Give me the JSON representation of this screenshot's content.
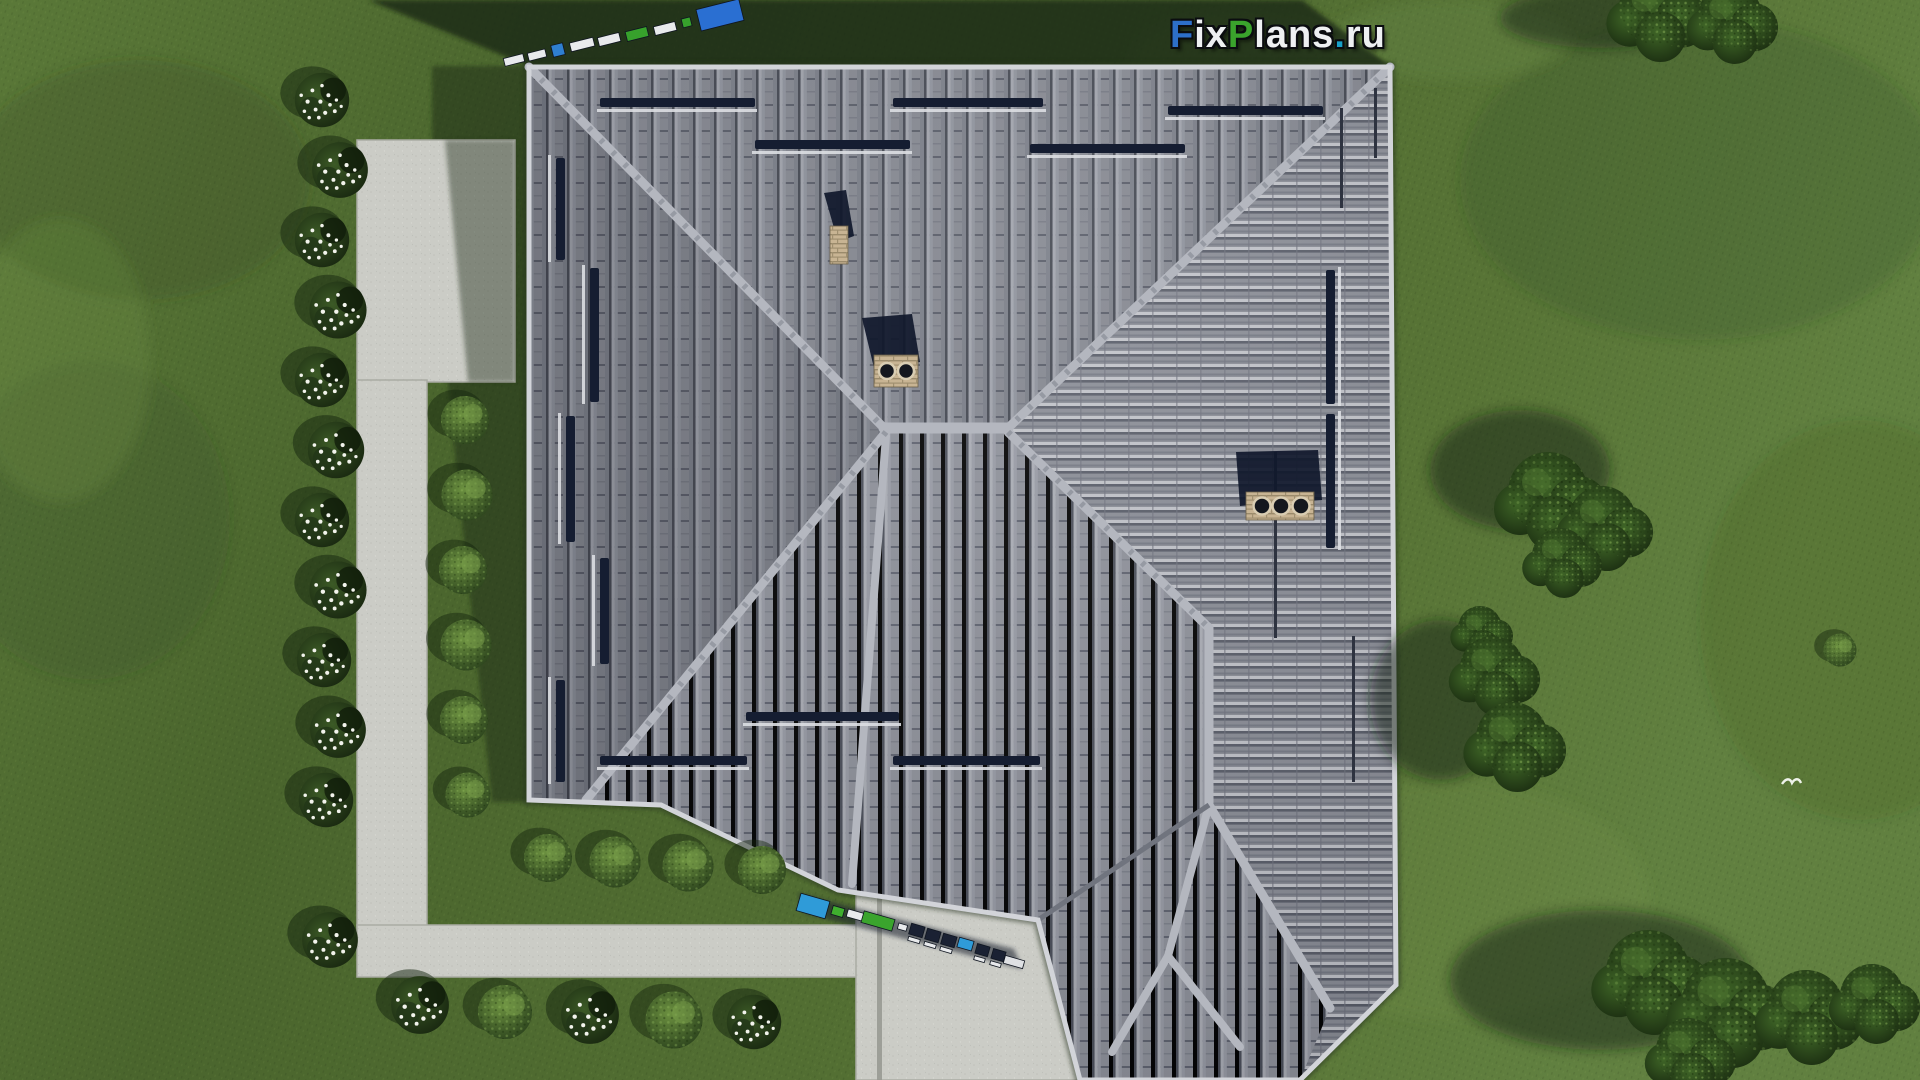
{
  "watermark": {
    "full_text": "FixPlans.ru",
    "parts": {
      "f": "F",
      "ix": "ix",
      "p": "P",
      "lans": "lans",
      "dot": ".",
      "ru": "ru"
    },
    "colors": {
      "blue": "#2d6fc9",
      "green": "#3aa32c",
      "white": "#eef0f2",
      "dot_teal": "#18a0c8",
      "outline": "#0b0d10"
    },
    "instances": [
      "top-right-text",
      "tilted-3d-logo-top-roof-edge",
      "tilted-3d-logo-bottom-walkway"
    ]
  },
  "scene": {
    "type": "aerial-3d-architectural-render",
    "subject": "Hip-roof house seen straight from above with lawn, garden paths, bushes and trees",
    "roof": {
      "tile_color": "#878a93",
      "tile_light_color": "#8f929b",
      "ridge_color": "#b4b7bf",
      "snow_guard_color": "#151d31",
      "chimneys": [
        {
          "name": "chimney-single",
          "flues": 1,
          "brick_color": "#c8b493"
        },
        {
          "name": "chimney-double",
          "flues": 2,
          "brick_color": "#c8b493"
        },
        {
          "name": "chimney-triple",
          "flues": 3,
          "brick_color": "#c8b493"
        }
      ]
    },
    "ground": {
      "grass_color": "#50692f",
      "shadow_color": "#1b2a14",
      "concrete_color": "#cbccc6"
    },
    "vegetation": {
      "flower_bushes": 15,
      "green_bushes": 13,
      "tree_clusters": 4
    },
    "bird": {
      "color": "#eef2ea"
    }
  }
}
